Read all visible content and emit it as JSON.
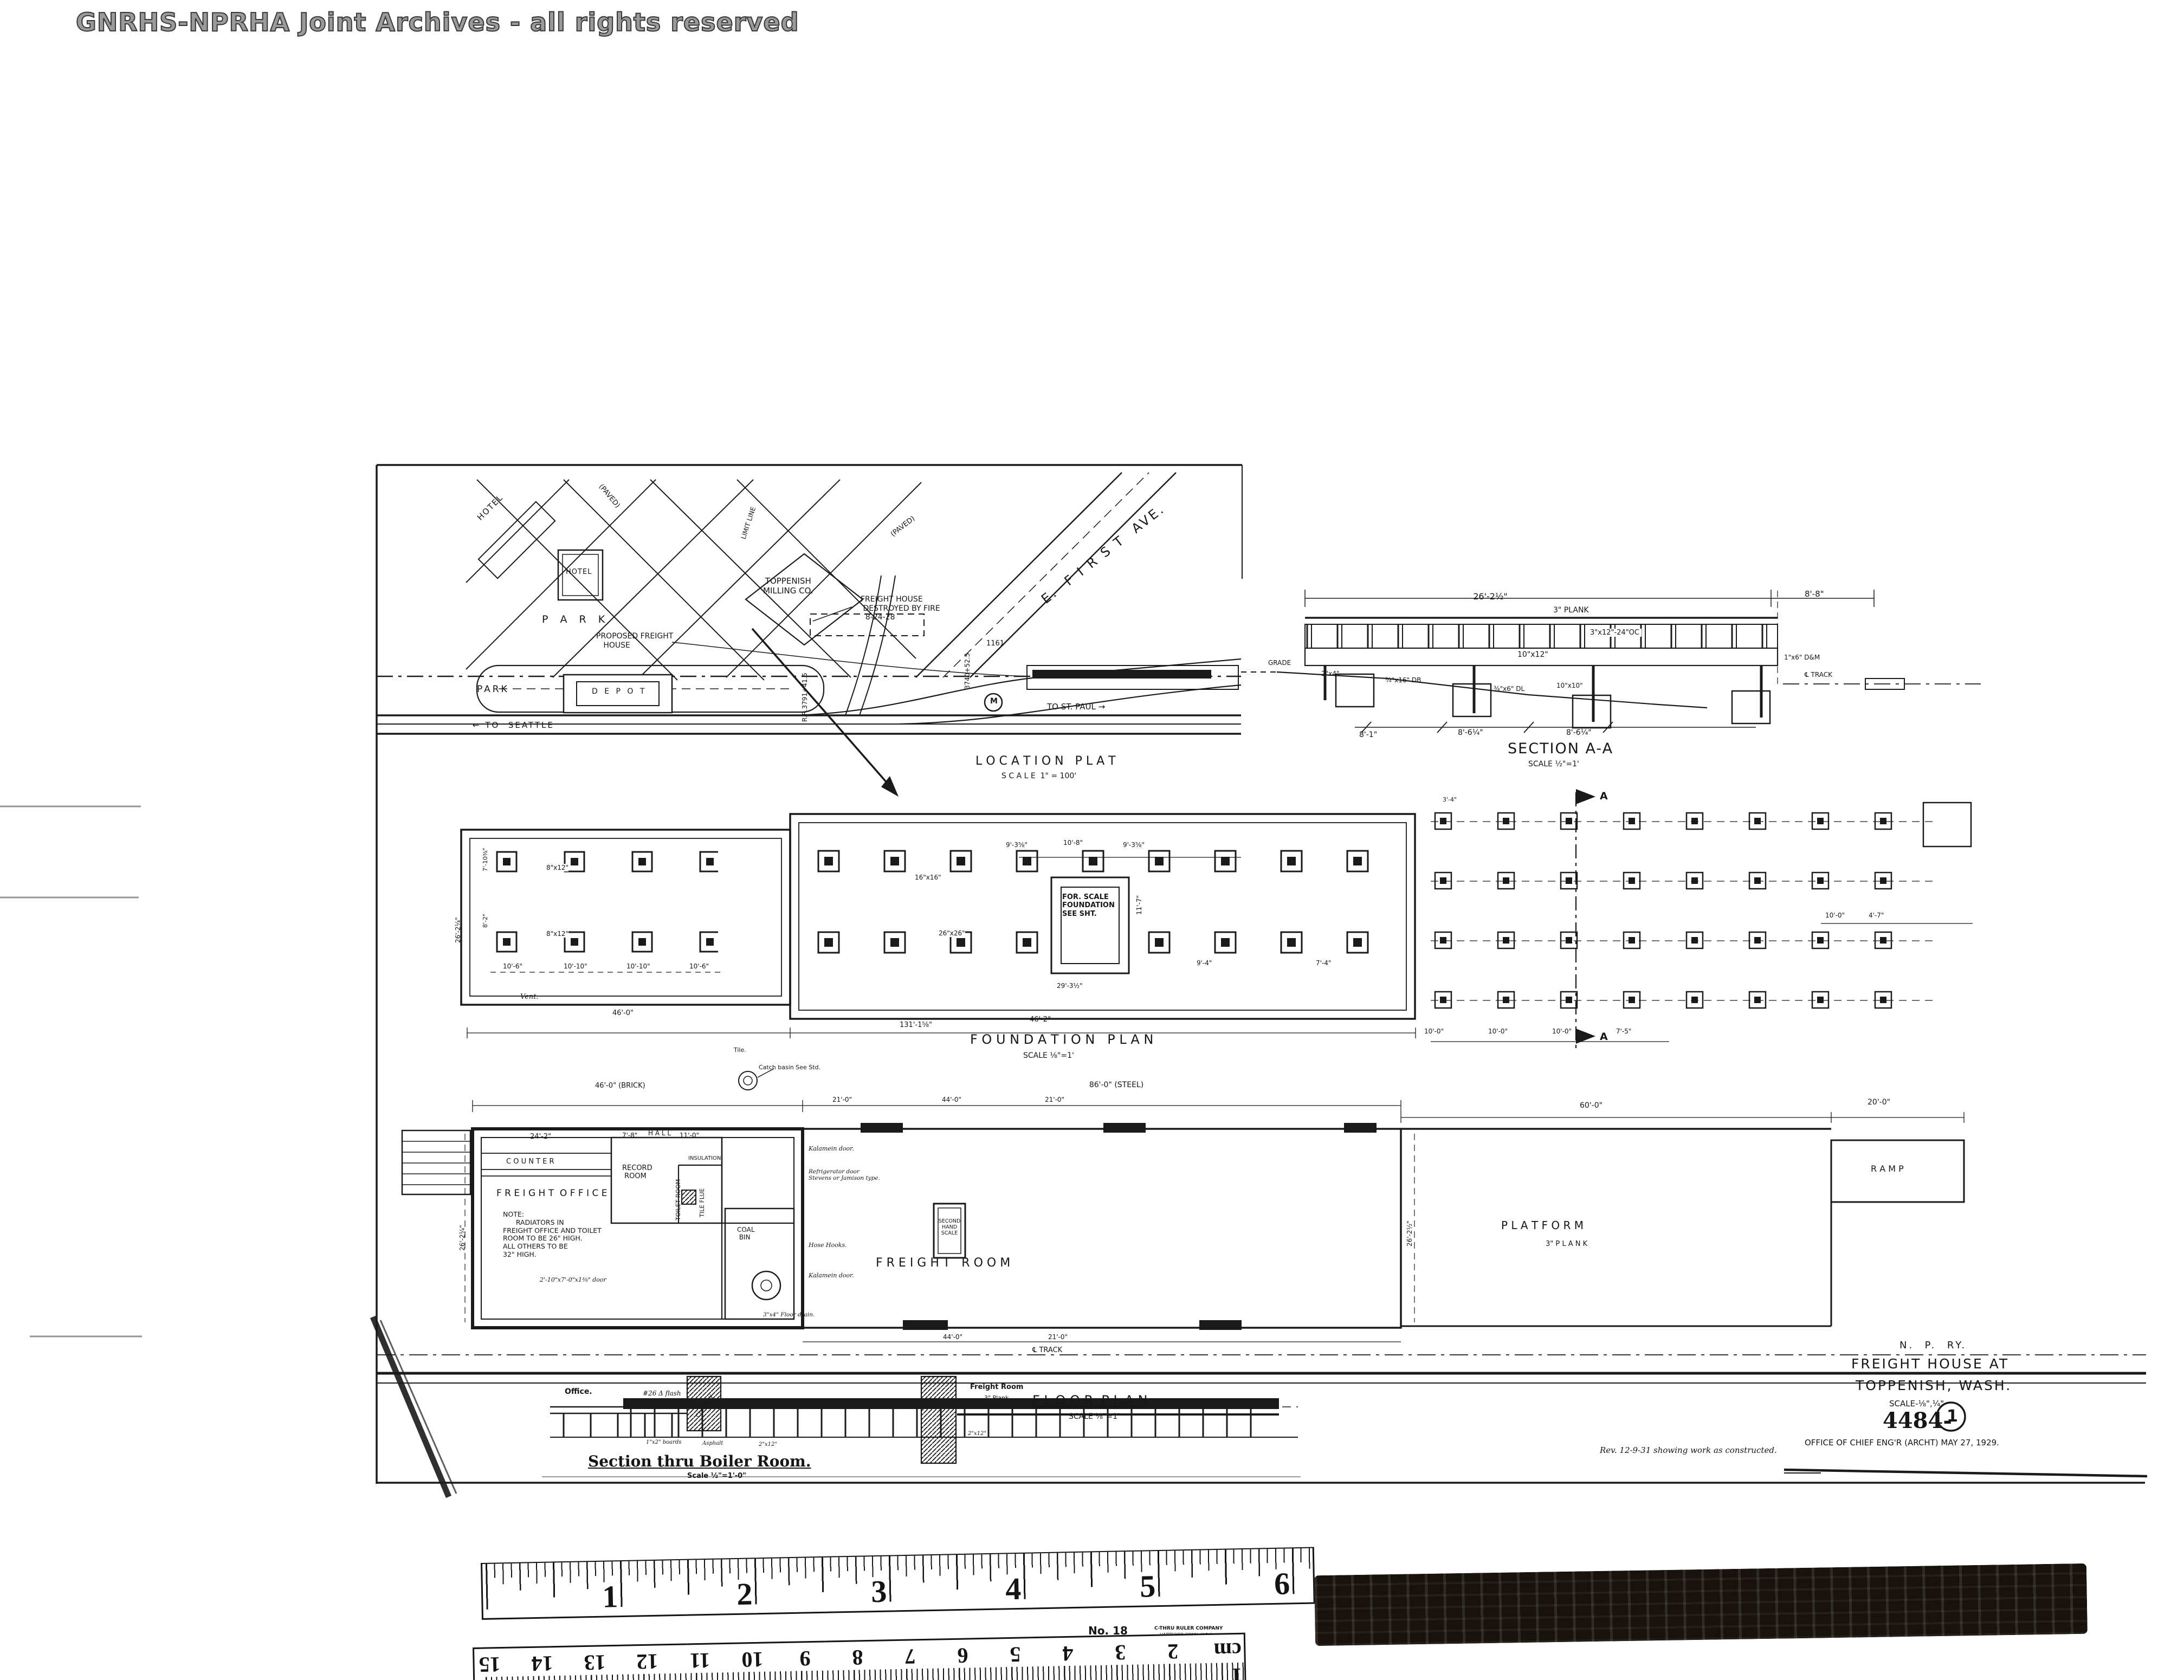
{
  "watermark": "GNRHS-NPRHA Joint Archives - all rights reserved",
  "location_plat": {
    "title": "L O C A T I O N   P L A T",
    "scale": "S C A L E  1\" = 100'",
    "hotel_diagonal": "HOTEL",
    "hotel_box": "HOTEL",
    "milling_co": "TOPPENISH\nMILLING CO.",
    "park_upper": "P A R K",
    "park_lower": "PARK",
    "depot": "D E P O T",
    "to_seattle": "← TO  SEATTLE",
    "to_st_paul": "TO ST. PAUL →",
    "street_e_first": "E.  F I R S T  AVE.",
    "paved_1": "(PAVED)",
    "paved_2": "(PAVED)",
    "limit_line": "LIMIT LINE",
    "destroyed_note": "FREIGHT HOUSE\n DESTROYED BY FIRE\n  8-24-28",
    "proposed_note": "PROPOSED FREIGHT\n   HOUSE",
    "survey_mark_1": "R.R.3791+41.5",
    "survey_mark_2": "3740+52.5",
    "mark_1161": "1161",
    "station_mark": "M"
  },
  "section_aa": {
    "title": "SECTION A-A",
    "scale": "SCALE ½\"=1'",
    "dim_26": "26'-2½\"",
    "dim_88": "8'-8\"",
    "plank": "3\" PLANK",
    "joists": "3\"x12\"-24\"OC",
    "beam": "10\"x12\"",
    "grade": "GRADE",
    "post_2x4": "2\"x4\"",
    "db": "¾\"x16\" DB",
    "dl": "¾\"x6\" DL",
    "post_10x10": "10\"x10\"",
    "dm": "1\"x6\" D&M",
    "dim_81": "8'-1\"",
    "dim_86a": "8'-6¼\"",
    "dim_86b": "8'-6¼\"",
    "track": "℄ TRACK"
  },
  "foundation_plan": {
    "title": "F O U N D A T I O N   P L A N",
    "scale": "SCALE ⅛\"=1'",
    "scale_box": "FOR. SCALE\nFOUNDATION\nSEE SHT.",
    "pier_8x12_a": "8\"x12\"",
    "pier_8x12_b": "8\"x12\"",
    "pier_16x16": "16\"x16\"",
    "pier_26x26": "26\"x26\"",
    "vent": "Vent.",
    "dim_106a": "10'-6\"",
    "dim_1010a": "10'-10\"",
    "dim_1010b": "10'-10\"",
    "dim_106b": "10'-6\"",
    "dim_460": "46'-0\"",
    "dim_462": "46'-2\"",
    "dim_131": "131'-1⅝\"",
    "dim_938a": "9'-3⅝\"",
    "dim_108": "10'-8\"",
    "dim_938b": "9'-3⅝\"",
    "dim_2932": "29'-3½\"",
    "dim_117": "11'-7\"",
    "dim_94": "9'-4\"",
    "dim_74": "7'-4\"",
    "dim_34": "3'-4\"",
    "dim_100a": "10'-0\"",
    "dim_100b": "10'-0\"",
    "dim_100c": "10'-0\"",
    "dim_75": "7'-5\"",
    "dim_100d": "10'-0\"",
    "dim_47": "4'-7\"",
    "dim_7103": "7'-10⅜\"",
    "dim_82": "8'-2\"",
    "dim_2624": "26'-2¼\"",
    "cut_a_top": "A",
    "cut_a_bottom": "A"
  },
  "floor_plan": {
    "title": "F L O O R  P L A N",
    "scale": "SCALE ⅛\"=1'",
    "track": "℄ TRACK",
    "dim_brick": "46'-0\" (BRICK)",
    "dim_steel": "86'-0\" (STEEL)",
    "dim_242": "24'-2\"",
    "dim_78": "7'-8\"",
    "hall": "H A L L",
    "dim_110": "11'-0\"",
    "counter": "C O U N T E R",
    "freight_office": "F R E I G H T  O F F I C E",
    "record_room": "RECORD\n ROOM",
    "toilet_room": "TOILET ROOM",
    "tile_flue": "TILE FLUE",
    "insulation": "INSULATION",
    "coal_bin": "COAL\n BIN",
    "note": "NOTE:\n      RADIATORS IN\nFREIGHT OFFICE AND TOILET\nROOM TO BE 26\" HIGH.\nALL OTHERS TO BE\n32\" HIGH.",
    "freight_room": "F R E I G H T   R O O M",
    "scale_box": "SECOND HAND\nSCALE",
    "platform": "P L A T F O R M",
    "platform_plank": "3\" P L A N K",
    "ramp": "R A M P",
    "dim_60": "60'-0\"",
    "dim_20": "20'-0\"",
    "dim_21a": "21'-0\"",
    "dim_44a": "44'-0\"",
    "dim_21b": "21'-0\"",
    "dim_44b": "44'-0\"",
    "dim_21c": "21'-0\"",
    "dim_2622a": "26'-2½\"",
    "dim_2622b": "26'-2¼\"",
    "door_kalamein_a": "Kalamein door.",
    "door_refrigerator": "Refrigerator door\nStevens or Jamison type.",
    "hose_hooks": "Hose Hooks.",
    "door_kalamein_b": "Kalamein door.",
    "door_note": "2'-10\"x7'-0\"x1⅜\" door",
    "floor_drain": "3\"x4\" Floor drain.",
    "catch_basin": "Catch basin See Std.",
    "tile": "Tile."
  },
  "boiler_section": {
    "title": "Section thru Boiler Room.",
    "scale": "Scale ½\"=1'-0\"",
    "office": "Office.",
    "chimney": "Chimney",
    "flash": "#26 Δ flash",
    "freight_room": "Freight Room",
    "plank": "3\" Plank",
    "boards": "1\"x2\" boards",
    "asphalt": "Asphalt",
    "joist_a": "2\"x12\"",
    "joist_b": "2\"x12\""
  },
  "title_block": {
    "railway": "N.  P.  RY.",
    "title_l1": "FREIGHT HOUSE AT",
    "title_l2": "TOPPENISH, WASH.",
    "scale": "SCALE-⅛\",¼\"",
    "drawing_number": "4484-",
    "sheet_number": "1",
    "office_date": "OFFICE OF CHIEF ENG'R (ARCHT) MAY 27, 1929.",
    "revision": "Rev. 12-9-31 showing work as constructed."
  },
  "ruler": {
    "inches": [
      "1",
      "2",
      "3",
      "4",
      "5",
      "6"
    ],
    "model": "No. 18",
    "maker_l1": "C-THRU RULER COMPANY",
    "maker_l2": "HARTFORD CONN. U.S.A.",
    "cm": [
      "15",
      "14",
      "13",
      "12",
      "11",
      "10",
      "9",
      "8",
      "7",
      "6",
      "5",
      "4",
      "3",
      "2"
    ],
    "cm_unit": "1 cm"
  }
}
